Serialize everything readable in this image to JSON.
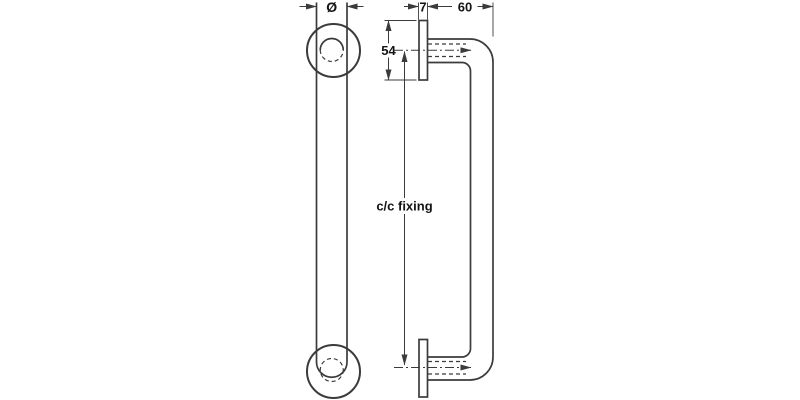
{
  "drawing": {
    "colors": {
      "line": "#3b3b3b",
      "text": "#141414",
      "background": "#ffffff"
    },
    "labels": {
      "diameter": "Ø",
      "plate_thickness": "7",
      "projection": "60",
      "plate_height": "54",
      "fixing_centers": "c/c fixing"
    }
  }
}
